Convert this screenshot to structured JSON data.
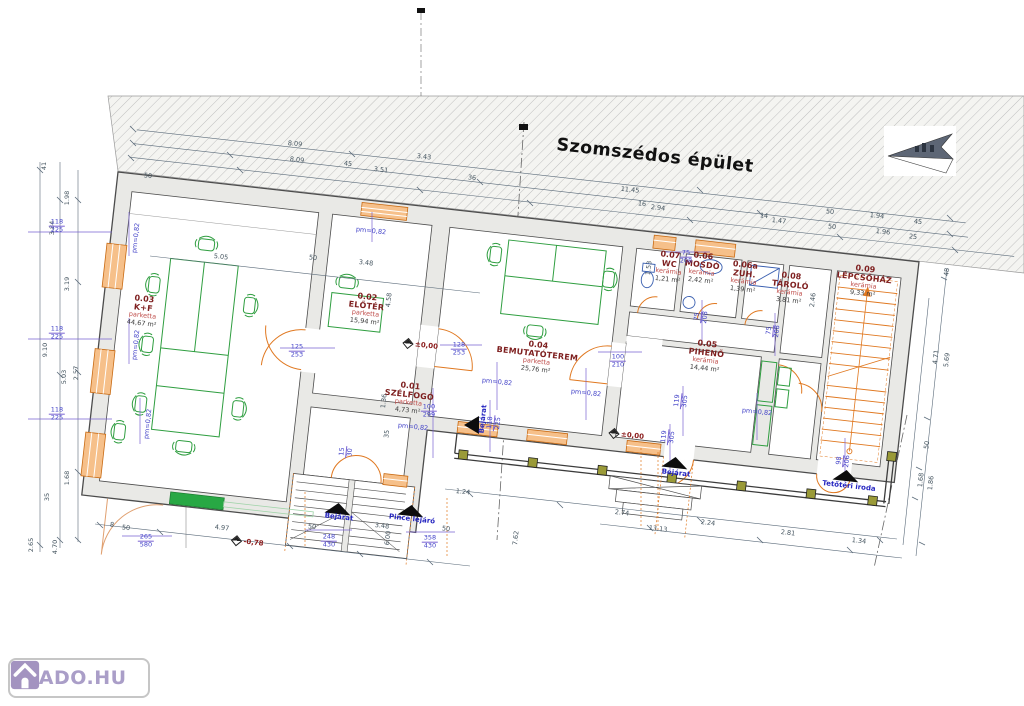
{
  "meta": {
    "neighbor_building_label": "Szomszédos épület"
  },
  "logo": {
    "text": "KIADO.HU"
  },
  "rooms": [
    {
      "id": "0.03",
      "name": "K+F",
      "finish": "parketta",
      "area": "44,67 m²",
      "x": 143,
      "y": 311
    },
    {
      "id": "0.02",
      "name": "ELŐTÉR",
      "finish": "parketta",
      "area": "15,94 m²",
      "x": 366,
      "y": 309
    },
    {
      "id": "0.01",
      "name": "SZÉLFOGÓ",
      "finish": "parketta",
      "area": "4,73 m²",
      "x": 409,
      "y": 398
    },
    {
      "id": "0.04",
      "name": "BEMUTATÓTEREM",
      "finish": "parketta",
      "area": "25,76 m²",
      "x": 537,
      "y": 357
    },
    {
      "id": "0.05",
      "name": "PIHENŐ",
      "finish": "kerámia",
      "area": "14,44 m²",
      "x": 706,
      "y": 356
    },
    {
      "id": "0.07",
      "name": "WC",
      "finish": "kerámia",
      "area": "1,21 m²",
      "x": 669,
      "y": 267
    },
    {
      "id": "0.06",
      "name": "MOSDÓ",
      "finish": "kerámia",
      "area": "2,42 m²",
      "x": 702,
      "y": 268
    },
    {
      "id": "0.06a",
      "name": "ZUH.",
      "finish": "kerámia",
      "area": "1,39 m²",
      "x": 744,
      "y": 277
    },
    {
      "id": "0.08",
      "name": "TÁROLÓ",
      "finish": "kerámia",
      "area": "3,81 m²",
      "x": 790,
      "y": 288
    },
    {
      "id": "0.09",
      "name": "LÉPCSŐHÁZ",
      "finish": "kerámia",
      "area": "9,33 m²",
      "x": 864,
      "y": 281
    }
  ],
  "entrances": [
    {
      "label": "Bejárat",
      "x": 339,
      "y": 517,
      "tx": 325,
      "ty": 503,
      "tri": "up",
      "rot": 6.4
    },
    {
      "label": "Pince lejáró",
      "x": 412,
      "y": 519,
      "tx": 398,
      "ty": 505,
      "tri": "up",
      "rot": 6.4
    },
    {
      "label": "Bejárat",
      "x": 676,
      "y": 473,
      "tx": 662,
      "ty": 457,
      "tri": "up",
      "rot": 6.4
    },
    {
      "label": "Tetőtéri iroda",
      "x": 849,
      "y": 486,
      "tx": 833,
      "ty": 470,
      "tri": "up",
      "rot": 6.4
    },
    {
      "label": "Bejárat",
      "x": 483,
      "y": 419,
      "tx": 464,
      "ty": 416,
      "tri": "left",
      "rot": -84
    }
  ],
  "levels": [
    {
      "text": "±0,00",
      "x": 421,
      "y": 345
    },
    {
      "text": "±0,00",
      "x": 627,
      "y": 435
    },
    {
      "text": "-0,78",
      "x": 248,
      "y": 542
    }
  ],
  "dims": [
    {
      "t": "50",
      "x": 148,
      "y": 176,
      "r": 6,
      "c": "d"
    },
    {
      "t": "8.09",
      "x": 295,
      "y": 144,
      "r": 6,
      "c": "d"
    },
    {
      "t": "8.09",
      "x": 297,
      "y": 160,
      "r": 6,
      "c": "d"
    },
    {
      "t": "45",
      "x": 348,
      "y": 164,
      "r": 6,
      "c": "d"
    },
    {
      "t": "3.43",
      "x": 424,
      "y": 157,
      "r": 6,
      "c": "d"
    },
    {
      "t": "3.51",
      "x": 381,
      "y": 170,
      "r": 6,
      "c": "d"
    },
    {
      "t": "36",
      "x": 472,
      "y": 178,
      "r": 6,
      "c": "d"
    },
    {
      "t": "11.45",
      "x": 630,
      "y": 190,
      "r": 6,
      "c": "d"
    },
    {
      "t": "16",
      "x": 642,
      "y": 204,
      "r": 6,
      "c": "d"
    },
    {
      "t": "2.94",
      "x": 658,
      "y": 208,
      "r": 6,
      "c": "d"
    },
    {
      "t": "14",
      "x": 764,
      "y": 216,
      "r": 6,
      "c": "d"
    },
    {
      "t": "1.47",
      "x": 779,
      "y": 221,
      "r": 6,
      "c": "d"
    },
    {
      "t": "50",
      "x": 830,
      "y": 212,
      "r": 6,
      "c": "d"
    },
    {
      "t": "1.94",
      "x": 877,
      "y": 216,
      "r": 6,
      "c": "d"
    },
    {
      "t": "45",
      "x": 918,
      "y": 222,
      "r": 6,
      "c": "d"
    },
    {
      "t": "50",
      "x": 832,
      "y": 227,
      "r": 6,
      "c": "d"
    },
    {
      "t": "1.96",
      "x": 883,
      "y": 232,
      "r": 6,
      "c": "d"
    },
    {
      "t": "25",
      "x": 913,
      "y": 237,
      "r": 6,
      "c": "d"
    },
    {
      "t": "48",
      "x": 947,
      "y": 272,
      "r": -84,
      "c": "d"
    },
    {
      "t": "4.71",
      "x": 936,
      "y": 357,
      "r": -84,
      "c": "d"
    },
    {
      "t": "5.69",
      "x": 947,
      "y": 360,
      "r": -84,
      "c": "d"
    },
    {
      "t": "50",
      "x": 927,
      "y": 445,
      "r": -84,
      "c": "d"
    },
    {
      "t": "1.68",
      "x": 921,
      "y": 480,
      "r": -84,
      "c": "d"
    },
    {
      "t": "1.86",
      "x": 931,
      "y": 483,
      "r": -84,
      "c": "d"
    },
    {
      "t": "41",
      "x": 44,
      "y": 166,
      "r": -90,
      "c": "d"
    },
    {
      "t": "1.98",
      "x": 67,
      "y": 198,
      "r": -90,
      "c": "d"
    },
    {
      "t": "3.84",
      "x": 52,
      "y": 228,
      "r": -90,
      "c": "d"
    },
    {
      "t": "3.19",
      "x": 67,
      "y": 284,
      "r": -90,
      "c": "d"
    },
    {
      "t": "9.10",
      "x": 45,
      "y": 350,
      "r": -90,
      "c": "d"
    },
    {
      "t": "5.03",
      "x": 64,
      "y": 377,
      "r": -90,
      "c": "d"
    },
    {
      "t": "2.57",
      "x": 76,
      "y": 373,
      "r": -90,
      "c": "d"
    },
    {
      "t": "1.68",
      "x": 67,
      "y": 478,
      "r": -90,
      "c": "d"
    },
    {
      "t": "35",
      "x": 47,
      "y": 497,
      "r": -90,
      "c": "d"
    },
    {
      "t": "2.65",
      "x": 31,
      "y": 545,
      "r": -90,
      "c": "d"
    },
    {
      "t": "4.70",
      "x": 55,
      "y": 547,
      "r": -90,
      "c": "d"
    },
    {
      "t": "8",
      "x": 112,
      "y": 525,
      "r": 6,
      "c": "d"
    },
    {
      "t": "50",
      "x": 126,
      "y": 528,
      "r": 6,
      "c": "d"
    },
    {
      "t": "4.97",
      "x": 222,
      "y": 528,
      "r": 6,
      "c": "d"
    },
    {
      "t": "50",
      "x": 312,
      "y": 527,
      "r": 6,
      "c": "d"
    },
    {
      "t": "3.48",
      "x": 382,
      "y": 526,
      "r": 6,
      "c": "d"
    },
    {
      "t": "50",
      "x": 446,
      "y": 529,
      "r": 6,
      "c": "d"
    },
    {
      "t": "6.00",
      "x": 388,
      "y": 538,
      "r": -84,
      "c": "d"
    },
    {
      "t": "7.62",
      "x": 516,
      "y": 538,
      "r": -84,
      "c": "d"
    },
    {
      "t": "1.24",
      "x": 463,
      "y": 492,
      "r": 6,
      "c": "d"
    },
    {
      "t": "2.74",
      "x": 622,
      "y": 513,
      "r": 6,
      "c": "d"
    },
    {
      "t": "13.13",
      "x": 658,
      "y": 529,
      "r": 6,
      "c": "d"
    },
    {
      "t": "2.24",
      "x": 708,
      "y": 523,
      "r": 6,
      "c": "d"
    },
    {
      "t": "2.81",
      "x": 788,
      "y": 533,
      "r": 6,
      "c": "d"
    },
    {
      "t": "1.34",
      "x": 859,
      "y": 541,
      "r": 6,
      "c": "d"
    },
    {
      "t": "5.05",
      "x": 221,
      "y": 257,
      "r": 6,
      "c": "d"
    },
    {
      "t": "50",
      "x": 313,
      "y": 258,
      "r": 6,
      "c": "d"
    },
    {
      "t": "3.48",
      "x": 366,
      "y": 263,
      "r": 6,
      "c": "d"
    },
    {
      "t": "4.58",
      "x": 389,
      "y": 300,
      "r": -84,
      "c": "d"
    },
    {
      "t": "1.36",
      "x": 384,
      "y": 401,
      "r": -84,
      "c": "d"
    },
    {
      "t": "35",
      "x": 387,
      "y": 434,
      "r": -84,
      "c": "d"
    },
    {
      "t": "2.46",
      "x": 813,
      "y": 300,
      "r": -84,
      "c": "d"
    },
    {
      "t": "1.53",
      "x": 649,
      "y": 268,
      "r": -84,
      "c": "d"
    },
    {
      "t": "118/225",
      "x": 57,
      "y": 226,
      "r": 0,
      "c": "b"
    },
    {
      "t": "118/225",
      "x": 57,
      "y": 333,
      "r": 0,
      "c": "b"
    },
    {
      "t": "118/225",
      "x": 57,
      "y": 414,
      "r": 0,
      "c": "b"
    },
    {
      "t": "pm=0,82",
      "x": 136,
      "y": 238,
      "r": -84,
      "c": "b"
    },
    {
      "t": "pm=0,82",
      "x": 136,
      "y": 345,
      "r": -84,
      "c": "b"
    },
    {
      "t": "pm=0,82",
      "x": 148,
      "y": 424,
      "r": -84,
      "c": "b"
    },
    {
      "t": "pm=0,82",
      "x": 371,
      "y": 231,
      "r": 6,
      "c": "b"
    },
    {
      "t": "125/253",
      "x": 297,
      "y": 351,
      "r": 0,
      "c": "b"
    },
    {
      "t": "128/253",
      "x": 459,
      "y": 349,
      "r": 0,
      "c": "b"
    },
    {
      "t": "100/299",
      "x": 429,
      "y": 411,
      "r": 0,
      "c": "b"
    },
    {
      "t": "pm=0,82",
      "x": 413,
      "y": 427,
      "r": 6,
      "c": "b"
    },
    {
      "t": "pm=0,82",
      "x": 497,
      "y": 382,
      "r": 6,
      "c": "b"
    },
    {
      "t": "pm=0,82",
      "x": 586,
      "y": 393,
      "r": 6,
      "c": "b"
    },
    {
      "t": "pm=0,82",
      "x": 757,
      "y": 412,
      "r": 6,
      "c": "b"
    },
    {
      "t": "118/225",
      "x": 494,
      "y": 423,
      "r": -84,
      "c": "b"
    },
    {
      "t": "100/210",
      "x": 618,
      "y": 361,
      "r": 0,
      "c": "b"
    },
    {
      "t": "75/208",
      "x": 686,
      "y": 257,
      "r": 0,
      "c": "b"
    },
    {
      "t": "75/208",
      "x": 701,
      "y": 317,
      "r": -84,
      "c": "b"
    },
    {
      "t": "75/208",
      "x": 773,
      "y": 331,
      "r": -84,
      "c": "b"
    },
    {
      "t": "119/305",
      "x": 681,
      "y": 401,
      "r": -84,
      "c": "b"
    },
    {
      "t": "119/305",
      "x": 668,
      "y": 437,
      "r": -84,
      "c": "b"
    },
    {
      "t": "98/206",
      "x": 843,
      "y": 461,
      "r": -84,
      "c": "b"
    },
    {
      "t": "248/430",
      "x": 329,
      "y": 541,
      "r": 0,
      "c": "b"
    },
    {
      "t": "358/430",
      "x": 430,
      "y": 542,
      "r": 0,
      "c": "b"
    },
    {
      "t": "265/580",
      "x": 146,
      "y": 541,
      "r": 0,
      "c": "b"
    },
    {
      "t": "15/30",
      "x": 346,
      "y": 452,
      "r": -84,
      "c": "b"
    }
  ]
}
